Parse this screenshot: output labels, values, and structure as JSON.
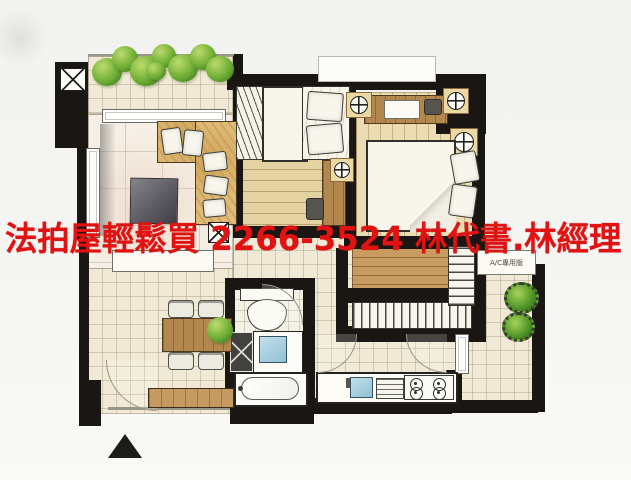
{
  "overlay": {
    "ad_text": "法拍屋輕鬆買 2266-3524 林代書.林經理",
    "ad_color": "#e01212"
  },
  "floorplan": {
    "ac_label": "A/C專用版",
    "entrance_marker": "triangle-up"
  },
  "colors": {
    "wall": "#191613",
    "floor_cream": "#f0e9d5",
    "wood": "#c89c60",
    "sofa_tan": "#debb77",
    "plant_green": "#6fae35",
    "sink_blue": "#8fc0d6",
    "background": "#f4f4f2"
  }
}
